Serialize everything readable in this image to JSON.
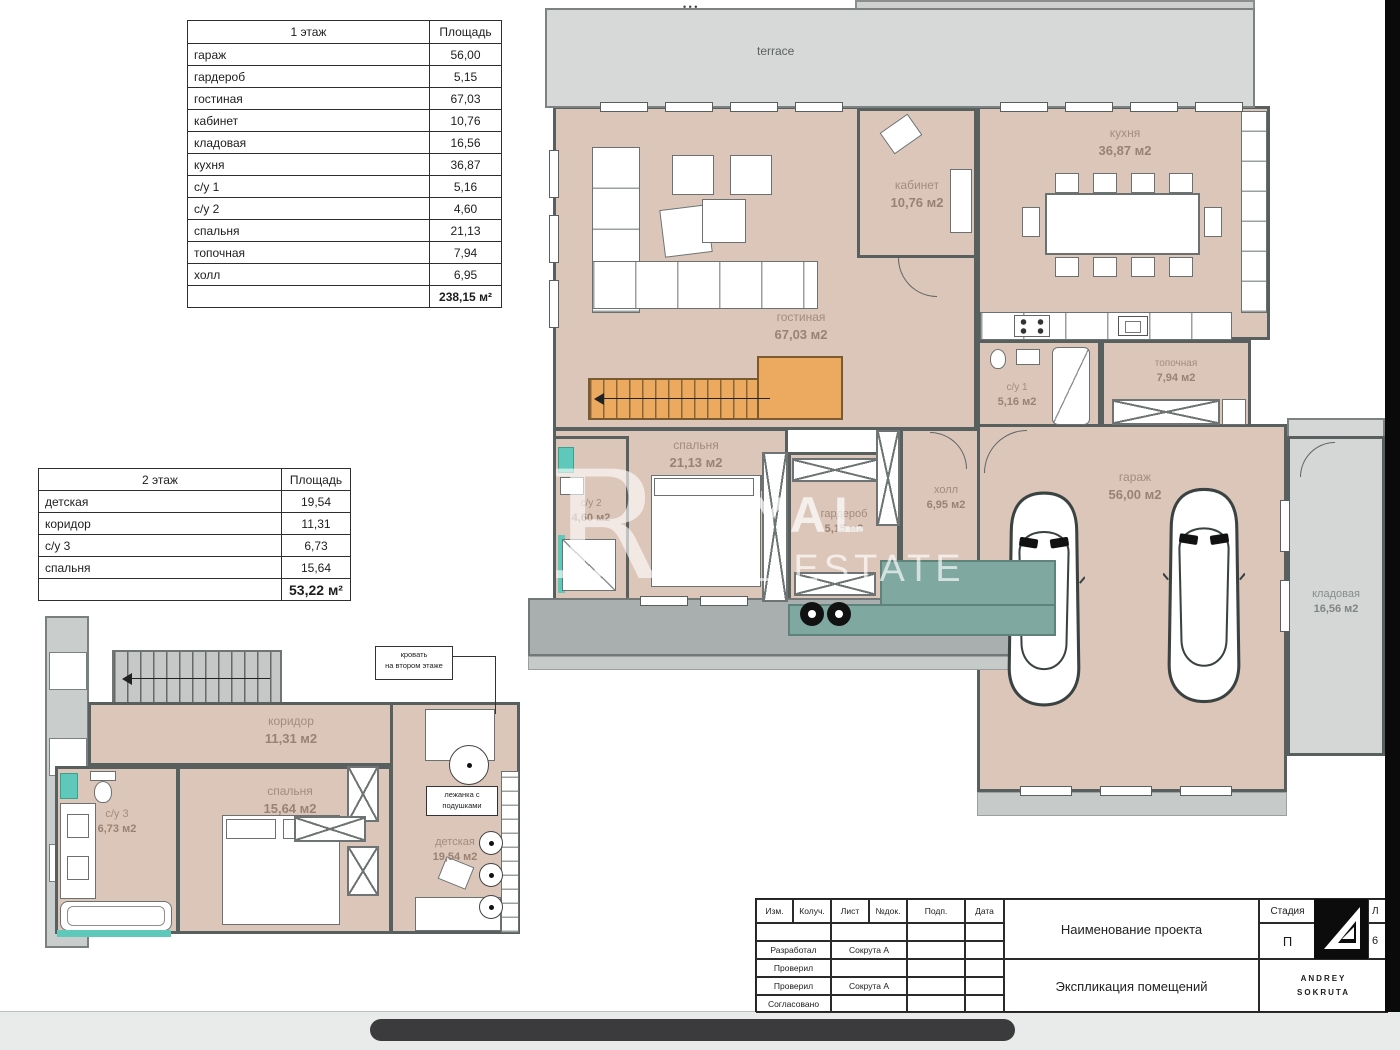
{
  "palette": {
    "floor_pink": "#dcc6ba",
    "floor_gray": "#d4d7d6",
    "wall": "#57605f",
    "stairs_orange": "#ecaa60",
    "entry_teal": "#7fa8a0",
    "teal_accent": "#5ec8ba",
    "scrollbar": "#3b3b3d",
    "logo_black": "#0c0c0c"
  },
  "watermark": {
    "letter": "R",
    "line1": "ROYAL",
    "line2": "REAL ESTATE"
  },
  "t1": {
    "title": "1 этаж",
    "area_header": "Площадь",
    "rows": [
      {
        "n": "гараж",
        "a": "56,00"
      },
      {
        "n": "гардероб",
        "a": "5,15"
      },
      {
        "n": "гостиная",
        "a": "67,03"
      },
      {
        "n": "кабинет",
        "a": "10,76"
      },
      {
        "n": "кладовая",
        "a": "16,56"
      },
      {
        "n": "кухня",
        "a": "36,87"
      },
      {
        "n": "с/у 1",
        "a": "5,16"
      },
      {
        "n": "с/у 2",
        "a": "4,60"
      },
      {
        "n": "спальня",
        "a": "21,13"
      },
      {
        "n": "топочная",
        "a": "7,94"
      },
      {
        "n": "холл",
        "a": "6,95"
      }
    ],
    "total": "238,15 м²"
  },
  "t2": {
    "title": "2 этаж",
    "area_header": "Площадь",
    "rows": [
      {
        "n": "детская",
        "a": "19,54"
      },
      {
        "n": "коридор",
        "a": "11,31"
      },
      {
        "n": "с/у 3",
        "a": "6,73"
      },
      {
        "n": "спальня",
        "a": "15,64"
      }
    ],
    "total": "53,22 м²"
  },
  "plan1": {
    "terrace": {
      "n": "terrace"
    },
    "dots": "• • •",
    "rooms": {
      "living": {
        "n": "гостиная",
        "a": "67,03 м2"
      },
      "kabinet": {
        "n": "кабинет",
        "a": "10,76 м2"
      },
      "kitchen": {
        "n": "кухня",
        "a": "36,87 м2"
      },
      "wc1": {
        "n": "с/у 1",
        "a": "5,16 м2"
      },
      "boiler": {
        "n": "топочная",
        "a": "7,94 м2"
      },
      "bedroom": {
        "n": "спальня",
        "a": "21,13 м2"
      },
      "wc2": {
        "n": "с/у 2",
        "a": "4,60 м2"
      },
      "wardrobe": {
        "n": "гардероб",
        "a": "5,15 м2"
      },
      "hall": {
        "n": "холл",
        "a": "6,95 м2"
      },
      "garage": {
        "n": "гараж",
        "a": "56,00 м2"
      },
      "storage": {
        "n": "кладовая",
        "a": "16,56 м2"
      }
    }
  },
  "plan2": {
    "rooms": {
      "corridor": {
        "n": "коридор",
        "a": "11,31 м2"
      },
      "wc3": {
        "n": "с/у 3",
        "a": "6,73 м2"
      },
      "bedroom": {
        "n": "спальня",
        "a": "15,64 м2"
      },
      "kids": {
        "n": "детская",
        "a": "19,54 м2"
      }
    },
    "bed_note": {
      "l1": "кровать",
      "l2": "на втором этаже"
    },
    "bench_note": {
      "l1": "лежанка с",
      "l2": "подушками"
    }
  },
  "titleblock": {
    "cols": [
      "Изм.",
      "Колуч.",
      "Лист",
      "№док.",
      "Подп.",
      "Дата"
    ],
    "rows": [
      {
        "label": "",
        "value": ""
      },
      {
        "label": "Разработал",
        "value": "Сокрута А"
      },
      {
        "label": "Проверил",
        "value": ""
      },
      {
        "label": "Проверил",
        "value": "Сокрута А"
      },
      {
        "label": "Согласовано",
        "value": ""
      }
    ],
    "project_title": "Наименование проекта",
    "doc_title": "Экспликация помещений",
    "stage_label": "Стадия",
    "stage_value": "П",
    "sheet_label": "Л",
    "sheet_value": "6",
    "logo_line1": "ANDREY",
    "logo_line2": "SOKRUTA"
  }
}
